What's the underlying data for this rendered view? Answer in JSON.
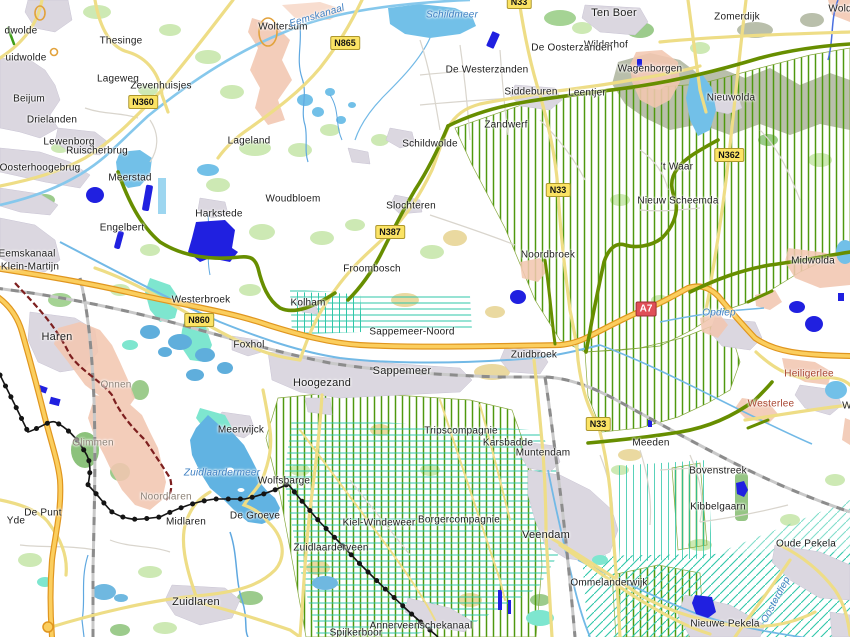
{
  "map": {
    "colors": {
      "motorway_fill": "#fbce5e",
      "motorway_casing": "#e0961f",
      "main_road": "#eedd86",
      "construction_road": "#678e00",
      "gasfield_hatch": "#4f990f",
      "drainage_teal": "#2fc7a9",
      "water": "#72c0e8",
      "deep_water_marker": "#2020e0",
      "urban": "#dbd7e0",
      "suburb_pink": "#f2c7b1",
      "marsh": "#b9bfab",
      "province_boundary": "#141414",
      "municipal_boundary": "#7d1f1f",
      "n_shield_bg": "#fbe364",
      "a_shield_bg": "#e04f57"
    },
    "labels": {
      "places": [
        {
          "t": "dwolde",
          "x": 21,
          "y": 31
        },
        {
          "t": "uidwolde",
          "x": 26,
          "y": 58
        },
        {
          "t": "Thesinge",
          "x": 121,
          "y": 41
        },
        {
          "t": "Ten Boer",
          "x": 614,
          "y": 13,
          "fs": 11
        },
        {
          "t": "Woltersum",
          "x": 283,
          "y": 27
        },
        {
          "t": "Wilderhof",
          "x": 606,
          "y": 45
        },
        {
          "t": "Zomerdijk",
          "x": 737,
          "y": 17
        },
        {
          "t": "Wolde",
          "x": 843,
          "y": 9
        },
        {
          "t": "Lageweg",
          "x": 118,
          "y": 79
        },
        {
          "t": "Zevenhuisjes",
          "x": 161,
          "y": 86
        },
        {
          "t": "Beijum",
          "x": 29,
          "y": 99
        },
        {
          "t": "Drielanden",
          "x": 52,
          "y": 120
        },
        {
          "t": "De Oosterzanden",
          "x": 572,
          "y": 48
        },
        {
          "t": "De Westerzanden",
          "x": 487,
          "y": 70
        },
        {
          "t": "Siddeburen",
          "x": 531,
          "y": 92
        },
        {
          "t": "Leentjer",
          "x": 587,
          "y": 93
        },
        {
          "t": "Zandwerf",
          "x": 506,
          "y": 125
        },
        {
          "t": "Wagenborgen",
          "x": 650,
          "y": 69
        },
        {
          "t": "Nieuwolda",
          "x": 731,
          "y": 98
        },
        {
          "t": "Lewenborg",
          "x": 69,
          "y": 142
        },
        {
          "t": "Ruischerbrug",
          "x": 97,
          "y": 151
        },
        {
          "t": "Oosterhoogebrug",
          "x": 40,
          "y": 168
        },
        {
          "t": "Lageland",
          "x": 249,
          "y": 141
        },
        {
          "t": "Meerstad",
          "x": 130,
          "y": 178
        },
        {
          "t": "Harkstede",
          "x": 219,
          "y": 214
        },
        {
          "t": "Engelbert",
          "x": 122,
          "y": 228
        },
        {
          "t": "Eemskanaal",
          "x": 27,
          "y": 254
        },
        {
          "t": "Klein-Martijn",
          "x": 30,
          "y": 267
        },
        {
          "t": "Woudbloem",
          "x": 293,
          "y": 199
        },
        {
          "t": "Schildwolde",
          "x": 430,
          "y": 144
        },
        {
          "t": "Slochteren",
          "x": 411,
          "y": 206
        },
        {
          "t": "Froombosch",
          "x": 372,
          "y": 269
        },
        {
          "t": "Noordbroek",
          "x": 548,
          "y": 255
        },
        {
          "t": "'t Waar",
          "x": 677,
          "y": 167
        },
        {
          "t": "Nieuw Scheemda",
          "x": 678,
          "y": 201
        },
        {
          "t": "Midwolda",
          "x": 813,
          "y": 261
        },
        {
          "t": "Westerbroek",
          "x": 201,
          "y": 300
        },
        {
          "t": "Kolham",
          "x": 308,
          "y": 303
        },
        {
          "t": "Foxhol",
          "x": 249,
          "y": 345
        },
        {
          "t": "Sappemeer-Noord",
          "x": 412,
          "y": 332
        },
        {
          "t": "Zuidbroek",
          "x": 534,
          "y": 355
        },
        {
          "t": "Sappemeer",
          "x": 402,
          "y": 371,
          "fs": 11
        },
        {
          "t": "Hoogezand",
          "x": 322,
          "y": 383,
          "fs": 11
        },
        {
          "t": "Haren",
          "x": 57,
          "y": 337,
          "fs": 11
        },
        {
          "t": "Meerwijck",
          "x": 241,
          "y": 430
        },
        {
          "t": "Wolfsbarge",
          "x": 284,
          "y": 481
        },
        {
          "t": "De Punt",
          "x": 43,
          "y": 513
        },
        {
          "t": "Yde",
          "x": 16,
          "y": 521
        },
        {
          "t": "Midlaren",
          "x": 186,
          "y": 522
        },
        {
          "t": "De Groeve",
          "x": 255,
          "y": 516
        },
        {
          "t": "Zuidlaarderveen",
          "x": 331,
          "y": 548
        },
        {
          "t": "Zuidlaren",
          "x": 196,
          "y": 602,
          "fs": 11
        },
        {
          "t": "Spijkerboor",
          "x": 356,
          "y": 633
        },
        {
          "t": "Annerveenschekanaal",
          "x": 421,
          "y": 626
        },
        {
          "t": "Tripscompagnie",
          "x": 461,
          "y": 431
        },
        {
          "t": "Karsbadde",
          "x": 508,
          "y": 443
        },
        {
          "t": "Muntendam",
          "x": 543,
          "y": 453
        },
        {
          "t": "Kiel-Windeweer",
          "x": 379,
          "y": 523
        },
        {
          "t": "Borgercompagnie",
          "x": 459,
          "y": 520
        },
        {
          "t": "Veendam",
          "x": 546,
          "y": 535,
          "fs": 11
        },
        {
          "t": "Meeden",
          "x": 651,
          "y": 443
        },
        {
          "t": "Bovenstreek",
          "x": 718,
          "y": 471
        },
        {
          "t": "Kibbelgaarn",
          "x": 718,
          "y": 507
        },
        {
          "t": "Oude Pekela",
          "x": 806,
          "y": 544
        },
        {
          "t": "Ommelanderwijk",
          "x": 609,
          "y": 583
        },
        {
          "t": "Nieuwe Pekela",
          "x": 725,
          "y": 624
        },
        {
          "t": "W",
          "x": 847,
          "y": 406
        }
      ],
      "places_gray": [
        {
          "t": "Onnen",
          "x": 116,
          "y": 385
        },
        {
          "t": "Glimmen",
          "x": 93,
          "y": 443
        },
        {
          "t": "Noordlaren",
          "x": 166,
          "y": 497
        }
      ],
      "places_red": [
        {
          "t": "Heiligerlee",
          "x": 809,
          "y": 374
        },
        {
          "t": "Westerlee",
          "x": 771,
          "y": 404
        }
      ],
      "water": [
        {
          "t": "Schildmeer",
          "x": 452,
          "y": 15
        },
        {
          "t": "Eemskanaal",
          "x": 317,
          "y": 16,
          "r": -17
        },
        {
          "t": "Zuidlaardermeer",
          "x": 222,
          "y": 473
        },
        {
          "t": "Opdiep",
          "x": 719,
          "y": 313
        },
        {
          "t": "Oosterdiep",
          "x": 776,
          "y": 600,
          "r": -62
        }
      ],
      "shields_n": [
        {
          "t": "N360",
          "x": 143,
          "y": 102
        },
        {
          "t": "N865",
          "x": 345,
          "y": 43
        },
        {
          "t": "N33",
          "x": 519,
          "y": 2
        },
        {
          "t": "N387",
          "x": 390,
          "y": 232
        },
        {
          "t": "N860",
          "x": 199,
          "y": 320
        },
        {
          "t": "N33",
          "x": 558,
          "y": 190
        },
        {
          "t": "N362",
          "x": 729,
          "y": 155
        },
        {
          "t": "N33",
          "x": 598,
          "y": 424
        }
      ],
      "shields_a": [
        {
          "t": "A7",
          "x": 646,
          "y": 309
        }
      ]
    }
  }
}
